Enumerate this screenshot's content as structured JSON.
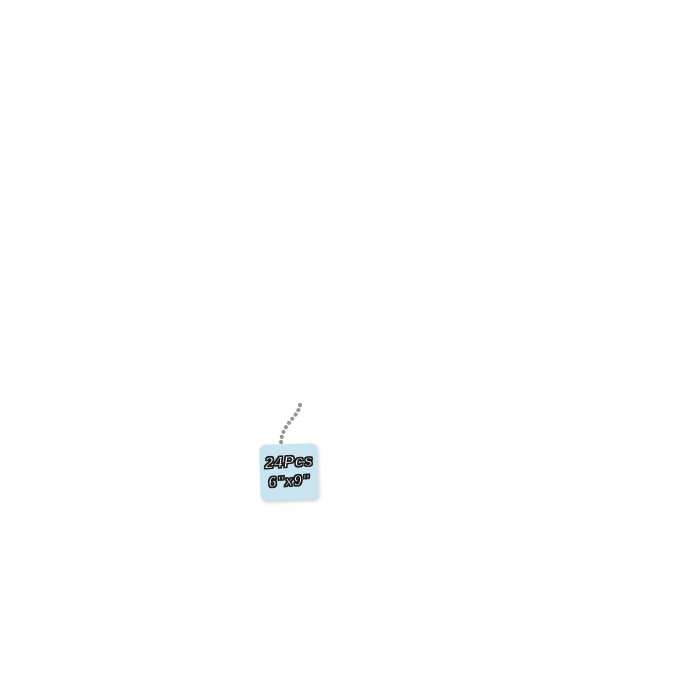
{
  "background": "#ffffff",
  "product": {
    "brand_label": "Steno Book",
    "tag": {
      "line1": "24Pcs",
      "line2": "6\"x9\"",
      "bg": "#c7e4f0",
      "text_color": "#ffffff",
      "outline_color": "#1b1b1b"
    }
  },
  "scene": {
    "columns": [
      {
        "name": "left-stack",
        "notebooks": [
          {
            "color_name": "lavender",
            "color": "#c7bddc",
            "left": 11,
            "top": 2,
            "width": 216,
            "height": 285
          },
          {
            "color_name": "teal",
            "color": "#a6c3c2",
            "left": 18,
            "top": 68,
            "width": 211,
            "height": 285
          },
          {
            "color_name": "light-blue",
            "color": "#b7e0f0",
            "left": 26,
            "top": 134,
            "width": 207,
            "height": 285
          },
          {
            "color_name": "yellow",
            "color": "#f4e593",
            "left": 33,
            "top": 199,
            "width": 202,
            "height": 285
          },
          {
            "color_name": "green",
            "color": "#aadab1",
            "left": 41,
            "top": 277,
            "width": 198,
            "height": 285
          },
          {
            "color_name": "lavender",
            "color": "#c7bddc",
            "left": 48,
            "top": 334,
            "width": 193,
            "height": 285
          },
          {
            "color_name": "yellow",
            "color": "#f5e69c",
            "left": 56,
            "top": 390,
            "width": 190,
            "height": 286,
            "front": true,
            "label_color": "#ddc878"
          }
        ]
      },
      {
        "name": "middle-stack",
        "notebooks": [
          {
            "color_name": "khaki",
            "color": "#cfc5a3",
            "left": 229,
            "top": 2,
            "width": 181,
            "height": 285
          },
          {
            "color_name": "yellow",
            "color": "#f4e38d",
            "left": 235,
            "top": 57,
            "width": 182,
            "height": 285
          },
          {
            "color_name": "teal",
            "color": "#aacec5",
            "left": 241,
            "top": 113,
            "width": 183,
            "height": 285
          },
          {
            "color_name": "lavender",
            "color": "#c4badb",
            "left": 247,
            "top": 165,
            "width": 184,
            "height": 285
          },
          {
            "color_name": "pink",
            "color": "#f6c3d0",
            "left": 253,
            "top": 222,
            "width": 185,
            "height": 285
          },
          {
            "color_name": "peach",
            "color": "#f0a184",
            "left": 259,
            "top": 277,
            "width": 186,
            "height": 285
          },
          {
            "color_name": "light-blue",
            "color": "#b4e0ee",
            "left": 264,
            "top": 333,
            "width": 187,
            "height": 285
          },
          {
            "color_name": "green",
            "color": "#b0d8ab",
            "left": 270,
            "top": 387,
            "width": 188,
            "height": 291,
            "front": true,
            "label_color": "#9cb5a3"
          }
        ]
      },
      {
        "name": "right-stack",
        "notebooks": [
          {
            "color_name": "sage",
            "color": "#a9c6c4",
            "left": 462,
            "top": 4,
            "width": 163,
            "height": 285
          },
          {
            "color_name": "peach",
            "color": "#efa287",
            "left": 466,
            "top": 57,
            "width": 171,
            "height": 285
          },
          {
            "color_name": "pink",
            "color": "#f6c3ce",
            "left": 470,
            "top": 112,
            "width": 175,
            "height": 285
          },
          {
            "color_name": "khaki",
            "color": "#cbc19e",
            "left": 474,
            "top": 164,
            "width": 181,
            "height": 285
          },
          {
            "color_name": "light-blue",
            "color": "#b5e1ef",
            "left": 478,
            "top": 218,
            "width": 184,
            "height": 285
          },
          {
            "color_name": "khaki",
            "color": "#cbc19e",
            "left": 482,
            "top": 258,
            "width": 186,
            "height": 285
          },
          {
            "color_name": "green",
            "color": "#abd7aa",
            "left": 486,
            "top": 321,
            "width": 186,
            "height": 285
          },
          {
            "color_name": "pink",
            "color": "#f8c8d2",
            "left": 490,
            "top": 387,
            "width": 186,
            "height": 289,
            "front": true,
            "label_color": "#eba7b7"
          }
        ]
      }
    ]
  }
}
